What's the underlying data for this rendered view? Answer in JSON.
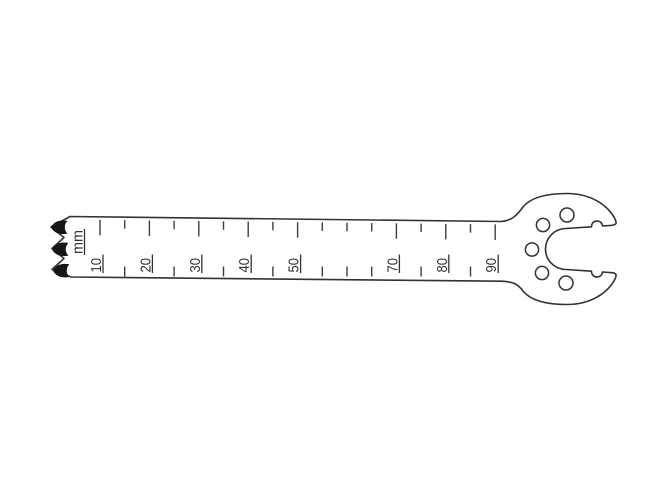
{
  "page": {
    "background": "#ffffff"
  },
  "drawing": {
    "subject": "oscillating saw blade with depth scale",
    "unit_label": "mm",
    "line_color": "#333333",
    "tick_color": "#3d3d3d",
    "tooth_fill": "#161616",
    "scale": {
      "unit": "mm",
      "labels": [
        "10",
        "20",
        "30",
        "40",
        "50",
        "70",
        "80",
        "90"
      ],
      "labeled_marks_mm": [
        10,
        20,
        30,
        40,
        50,
        70,
        80,
        90
      ],
      "minor_marks_mm": [
        15,
        25,
        35,
        45,
        55,
        60,
        65,
        75,
        85
      ]
    },
    "teeth_count": 3,
    "hub": {
      "hole_count": 5,
      "notch_count": 2
    }
  }
}
